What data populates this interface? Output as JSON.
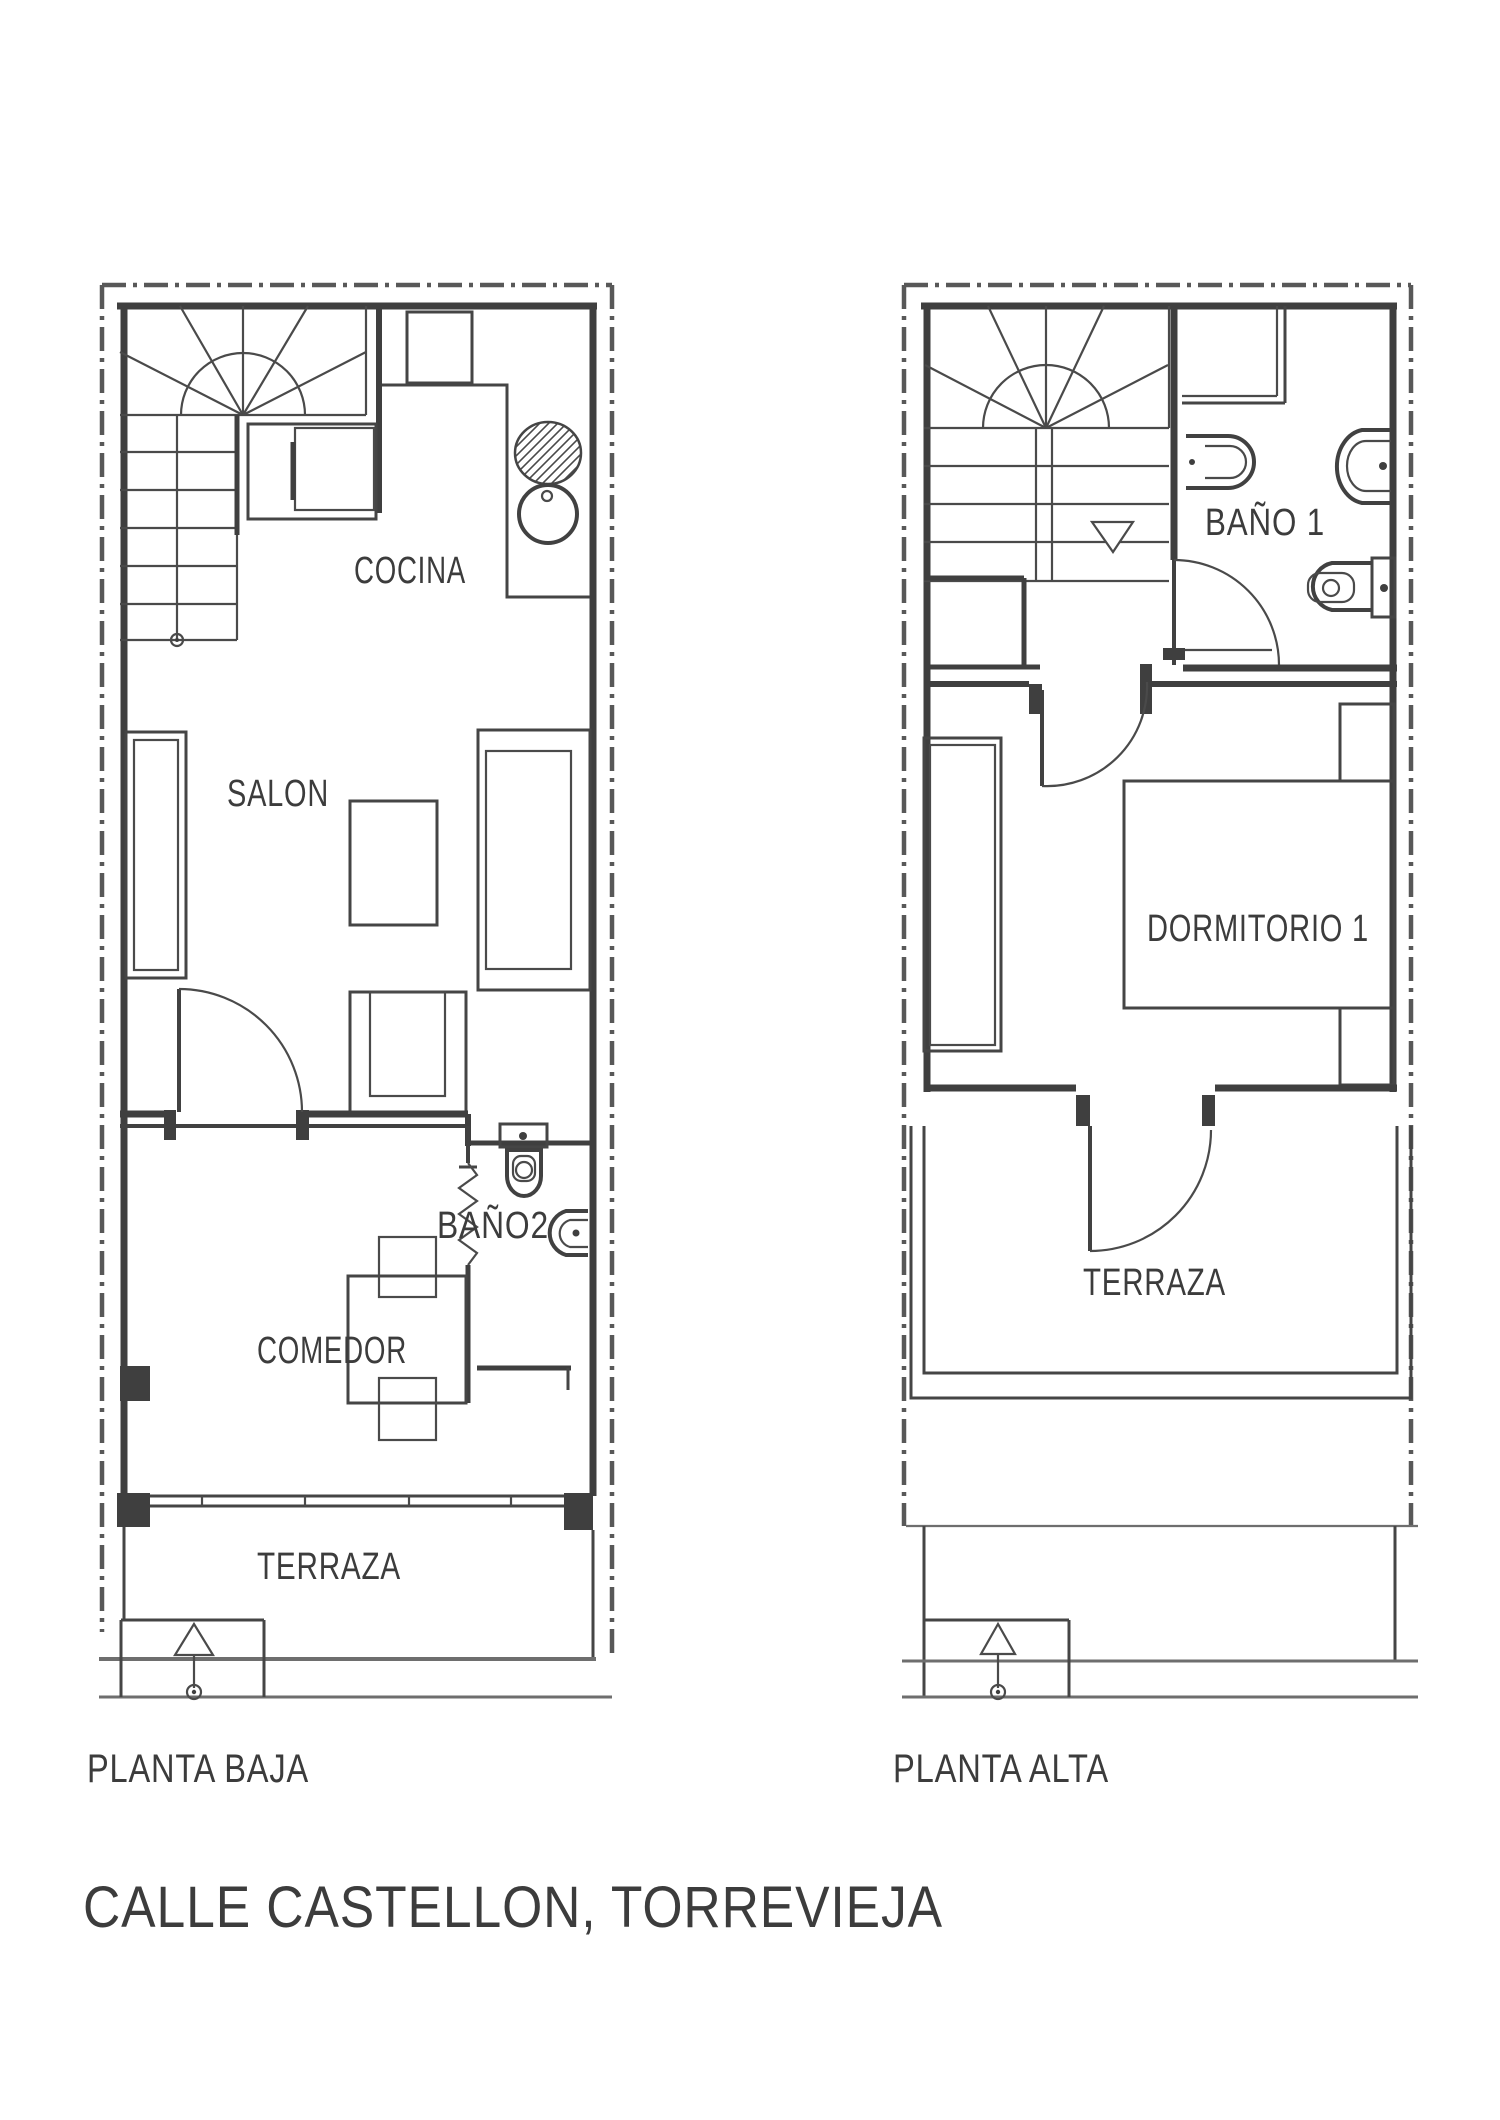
{
  "drawing": {
    "title": "CALLE CASTELLON, TORREVIEJA",
    "floors": [
      {
        "name": "PLANTA BAJA",
        "rooms": [
          "COCINA",
          "SALON",
          "COMEDOR",
          "BAÑO2",
          "TERRAZA"
        ]
      },
      {
        "name": "PLANTA ALTA",
        "rooms": [
          "BAÑO 1",
          "DORMITORIO 1",
          "TERRAZA"
        ]
      }
    ]
  },
  "labels": {
    "cocina": "COCINA",
    "salon": "SALON",
    "comedor": "COMEDOR",
    "bano2": "BAÑO2",
    "terraza_ground": "TERRAZA",
    "bano1": "BAÑO 1",
    "dormitorio1": "DORMITORIO 1",
    "terraza_upper": "TERRAZA",
    "planta_baja": "PLANTA BAJA",
    "planta_alta": "PLANTA ALTA"
  },
  "colors": {
    "ink": "#3f3f3f",
    "light_line": "#6e6e6e",
    "background": "#ffffff"
  }
}
